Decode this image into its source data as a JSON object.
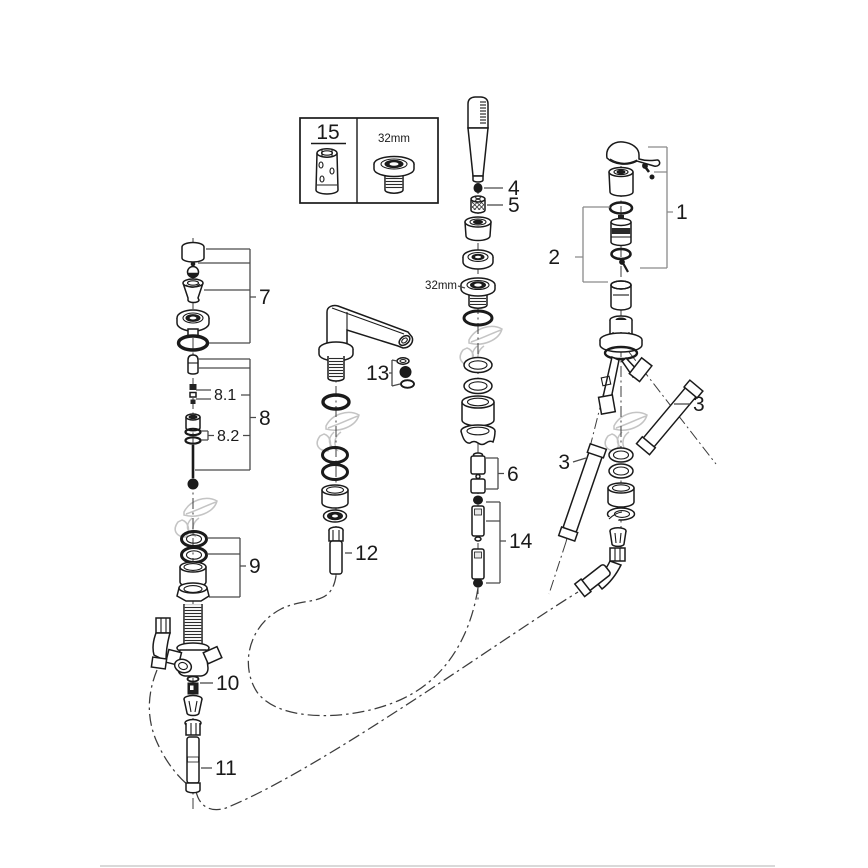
{
  "legend": {
    "part_number": "15",
    "size_label": "32mm"
  },
  "callouts": {
    "c1": "1",
    "c2": "2",
    "c3_right": "3",
    "c3_left": "3",
    "c4": "4",
    "c5": "5",
    "c6": "6",
    "c7": "7",
    "c8": "8",
    "c8_1": "8.1",
    "c8_2": "8.2",
    "c9": "9",
    "c10": "10",
    "c11": "11",
    "c12": "12",
    "c13": "13",
    "c14": "14",
    "size_mid": "32mm"
  },
  "colors": {
    "line": "#1a1a1a",
    "callout_line": "#4a4a4a",
    "callout_line_light": "#8a8a8a",
    "watermark": "#c4c4c4",
    "divider": "#d9d9d9",
    "background": "#ffffff"
  }
}
